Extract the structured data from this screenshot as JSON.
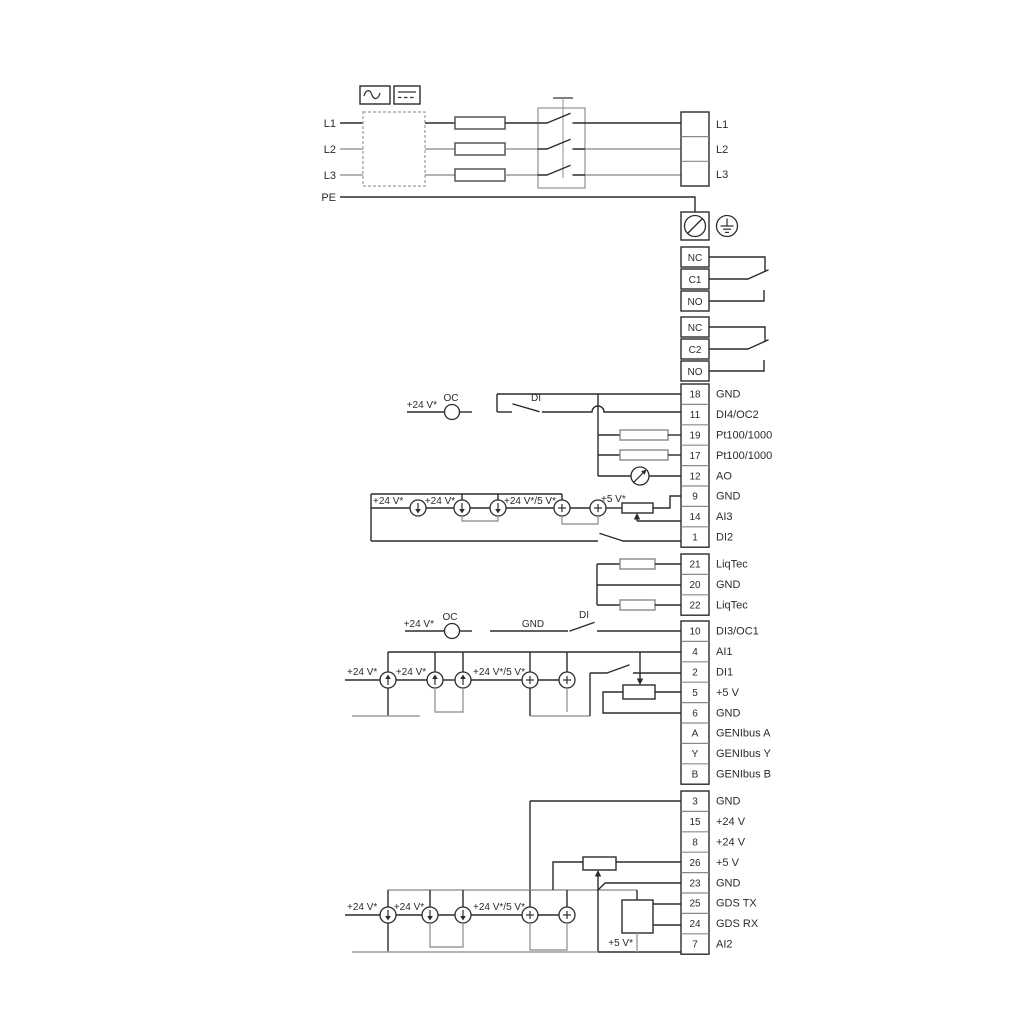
{
  "diagram": {
    "power_in": [
      "L1",
      "L2",
      "L3",
      "PE"
    ],
    "power_out": [
      "L1",
      "L2",
      "L3"
    ],
    "relay1": [
      "NC",
      "C1",
      "NO"
    ],
    "relay2": [
      "NC",
      "C2",
      "NO"
    ],
    "strip1": [
      {
        "n": "18",
        "t": "GND"
      },
      {
        "n": "11",
        "t": "DI4/OC2"
      },
      {
        "n": "19",
        "t": "Pt100/1000"
      },
      {
        "n": "17",
        "t": "Pt100/1000"
      },
      {
        "n": "12",
        "t": "AO"
      },
      {
        "n": "9",
        "t": "GND"
      },
      {
        "n": "14",
        "t": "AI3"
      },
      {
        "n": "1",
        "t": "DI2"
      }
    ],
    "strip2": [
      {
        "n": "21",
        "t": "LiqTec"
      },
      {
        "n": "20",
        "t": "GND"
      },
      {
        "n": "22",
        "t": "LiqTec"
      }
    ],
    "strip3": [
      {
        "n": "10",
        "t": "DI3/OC1"
      },
      {
        "n": "4",
        "t": "AI1"
      },
      {
        "n": "2",
        "t": "DI1"
      },
      {
        "n": "5",
        "t": "+5 V"
      },
      {
        "n": "6",
        "t": "GND"
      },
      {
        "n": "A",
        "t": "GENIbus A"
      },
      {
        "n": "Y",
        "t": "GENIbus Y"
      },
      {
        "n": "B",
        "t": "GENIbus B"
      }
    ],
    "strip4": [
      {
        "n": "3",
        "t": "GND"
      },
      {
        "n": "15",
        "t": "+24 V"
      },
      {
        "n": "8",
        "t": "+24 V"
      },
      {
        "n": "26",
        "t": "+5 V"
      },
      {
        "n": "23",
        "t": "GND"
      },
      {
        "n": "25",
        "t": "GDS TX"
      },
      {
        "n": "24",
        "t": "GDS RX"
      },
      {
        "n": "7",
        "t": "AI2"
      }
    ],
    "ann": {
      "v24": "+24 V*",
      "v24_5": "+24 V*/5 V*",
      "v5": "+5 V*",
      "oc": "OC",
      "di": "DI",
      "gnd": "GND"
    },
    "colors": {
      "wire": "#2b2b2b",
      "wire_gray": "#9b9b9b"
    }
  }
}
